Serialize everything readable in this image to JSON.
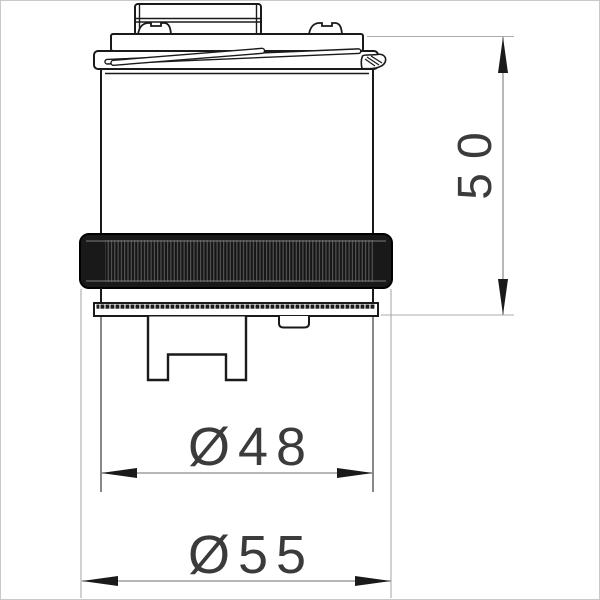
{
  "drawing": {
    "type": "technical-drawing-cartridge-front-view",
    "dimensions": {
      "height": {
        "label": "50",
        "orientation": "vertical"
      },
      "diameter_inner": {
        "label": "Ø48",
        "orientation": "horizontal"
      },
      "diameter_outer": {
        "label": "Ø55",
        "orientation": "horizontal"
      }
    },
    "colors": {
      "part_line": "#1a1a1a",
      "dimension_line": "#8a8a8a",
      "extension_line": "#ababab",
      "dimension_text": "#3b3b3b",
      "knurl_ring_fill": "#191919",
      "background": "#ffffff",
      "page_frame": "#c9c9c9"
    }
  }
}
